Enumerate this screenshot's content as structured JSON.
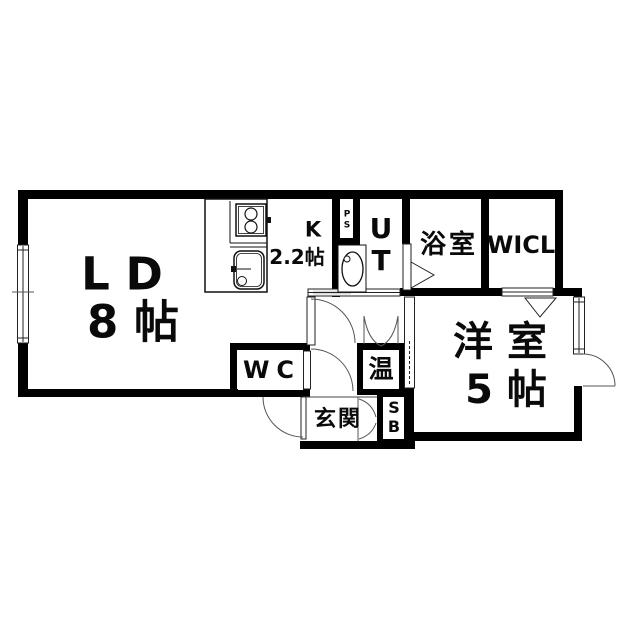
{
  "plan": {
    "type": "apartment-floor-plan",
    "colors": {
      "wall": "#000000",
      "background": "#ffffff",
      "thin_line": "#444444"
    },
    "rooms": {
      "living_dining": {
        "name_line1": "L D",
        "name_line2": "8 帖"
      },
      "kitchen": {
        "label": "K",
        "size": "2.2帖"
      },
      "pipe_space": {
        "letter1": "P",
        "letter2": "S"
      },
      "utility": {
        "letter1": "U",
        "letter2": "T"
      },
      "bathroom": {
        "label": "浴室"
      },
      "walk_in_closet": {
        "label": "WICL"
      },
      "toilet": {
        "label": "WC"
      },
      "water_heater": {
        "label": "温"
      },
      "entrance": {
        "label": "玄関"
      },
      "shoe_box": {
        "letter1": "S",
        "letter2": "B"
      },
      "western_room": {
        "name_line1": "洋 室",
        "name_line2": "5 帖"
      }
    }
  }
}
